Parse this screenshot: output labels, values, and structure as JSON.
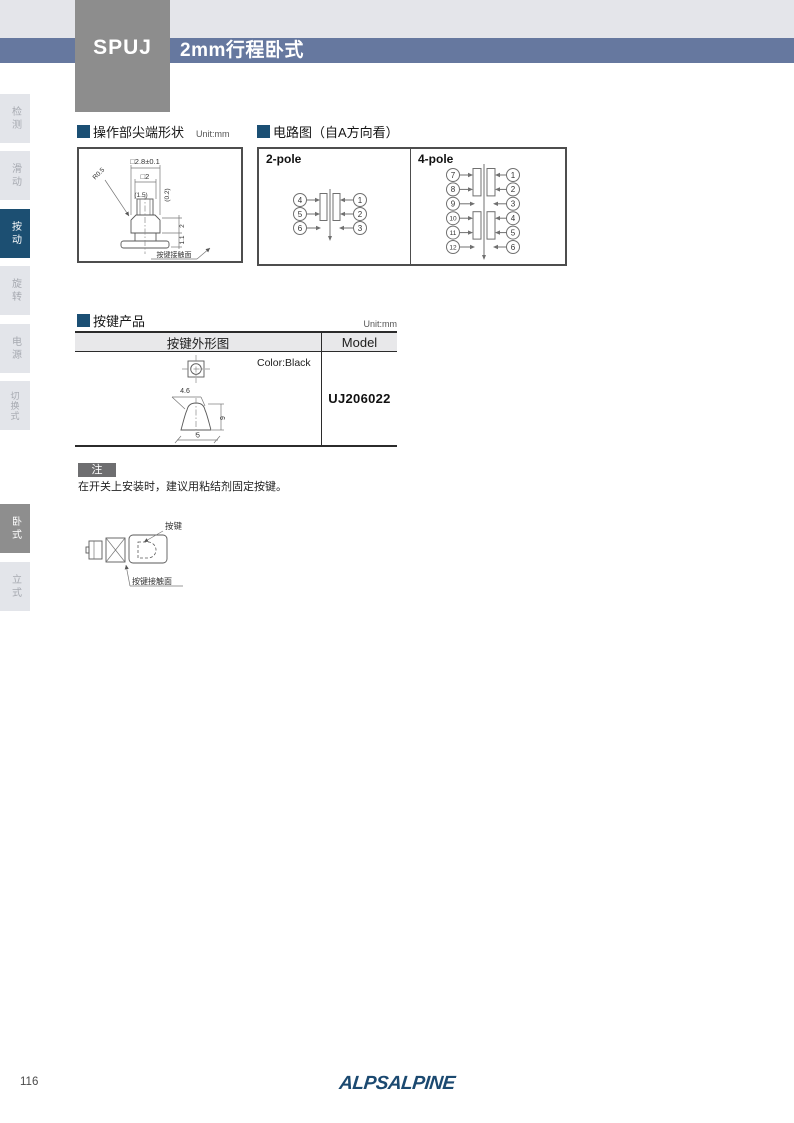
{
  "header": {
    "series": "SPUJ",
    "title": "2mm行程卧式"
  },
  "sidebar": {
    "items": [
      {
        "label": "检测",
        "active": false
      },
      {
        "label": "滑动",
        "active": false
      },
      {
        "label": "按动",
        "active": true
      },
      {
        "label": "旋转",
        "active": false
      },
      {
        "label": "电源",
        "active": false
      },
      {
        "label": "切换式",
        "active": false
      }
    ],
    "mount": [
      {
        "label": "卧式",
        "active": true
      },
      {
        "label": "立式",
        "active": false
      }
    ]
  },
  "tip_section": {
    "title": "操作部尖端形状",
    "unit": "Unit:mm",
    "dims": {
      "outer": "□2.8±0.1",
      "top": "□2",
      "w15": "(1.5)",
      "d02": "(0.2)",
      "r": "R0.5",
      "h2": "2",
      "h11": "1.1",
      "contact": "按键接触面"
    }
  },
  "circuit_section": {
    "title": "电路图（自A方向看）",
    "two_pole": {
      "label": "2-pole",
      "left": [
        "4",
        "5",
        "6"
      ],
      "right": [
        "1",
        "2",
        "3"
      ]
    },
    "four_pole": {
      "label": "4-pole",
      "left": [
        "7",
        "8",
        "9",
        "10",
        "11",
        "12"
      ],
      "right": [
        "1",
        "2",
        "3",
        "4",
        "5",
        "6"
      ]
    }
  },
  "keytop_section": {
    "title": "按键产品",
    "unit": "Unit:mm",
    "table": {
      "headers": [
        "按键外形图",
        "Model"
      ],
      "color_note": "Color:Black",
      "model": "UJ206022",
      "dims": {
        "top_width": "4.6",
        "height": "9",
        "bottom_width": "5"
      }
    }
  },
  "note": {
    "badge": "注",
    "text": "在开关上安装时，建议用粘结剂固定按键。"
  },
  "mount_figure": {
    "key": "按键",
    "contact": "按键接触面"
  },
  "footer": {
    "page": "116",
    "brand": "ALPSALPINE"
  },
  "colors": {
    "accent_blue": "#66789F",
    "active_tab_blue": "#1C4F72",
    "series_gray": "#8D8D8D",
    "mount_active_gray": "#8E8E8E",
    "note_badge_gray": "#6E6E70",
    "brand_blue": "#1B4970",
    "section_bullet": "#1B4F74"
  }
}
